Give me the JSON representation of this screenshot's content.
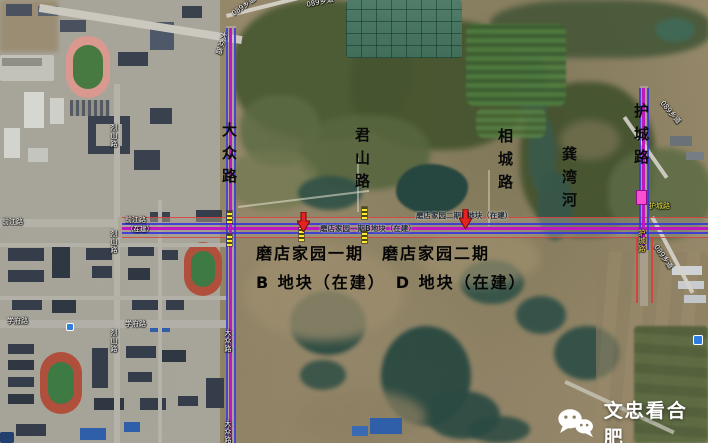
{
  "annotations": {
    "roads_large": {
      "dazhong": "大众路",
      "junshan": "君山路",
      "xiangcheng": "相城路",
      "gongwan": "龚湾河",
      "hucheng": "护城路"
    },
    "estate": {
      "line1": "磨店家园一期　磨店家园二期",
      "line2": "B 地块（在建）　D 地块（在建）"
    }
  },
  "map_labels": {
    "qianjiang_w": "前江路",
    "qianjiang_c": "前江路",
    "qianjiang_c2": "（在建）",
    "xuefu_w": "学府路",
    "xuefu_c": "学府路",
    "lieshan_n": "烈山路",
    "lieshan_m": "烈山路",
    "lieshan_s": "烈山路",
    "dazhong_diag": "大众路",
    "dazhong_s1": "大众路",
    "dazhong_s2": "大众路",
    "xd089_nw1": "089乡道",
    "xd089_nw2": "089乡道",
    "xd089_ne": "089乡道",
    "xd089_se": "089乡道",
    "plot_b": "磨店家园一期B地块（在建）",
    "plot_d": "磨店家园二期D地块（在建）",
    "hucheng_h": "护城路",
    "hucheng_v": "护城路"
  },
  "watermark": {
    "text": "文忠看合肥"
  },
  "icons": {
    "watermark_logo": "wechat-chat-bubbles"
  },
  "colors": {
    "road_magenta": "#c017c0",
    "road_blue": "#3b36d8",
    "road_red": "#e03a3a",
    "label_yellow": "#ece64a",
    "annotation_black": "#0a0a0a",
    "marker_pink": "#fa4fd0",
    "watermark_white": "#ffffff"
  }
}
